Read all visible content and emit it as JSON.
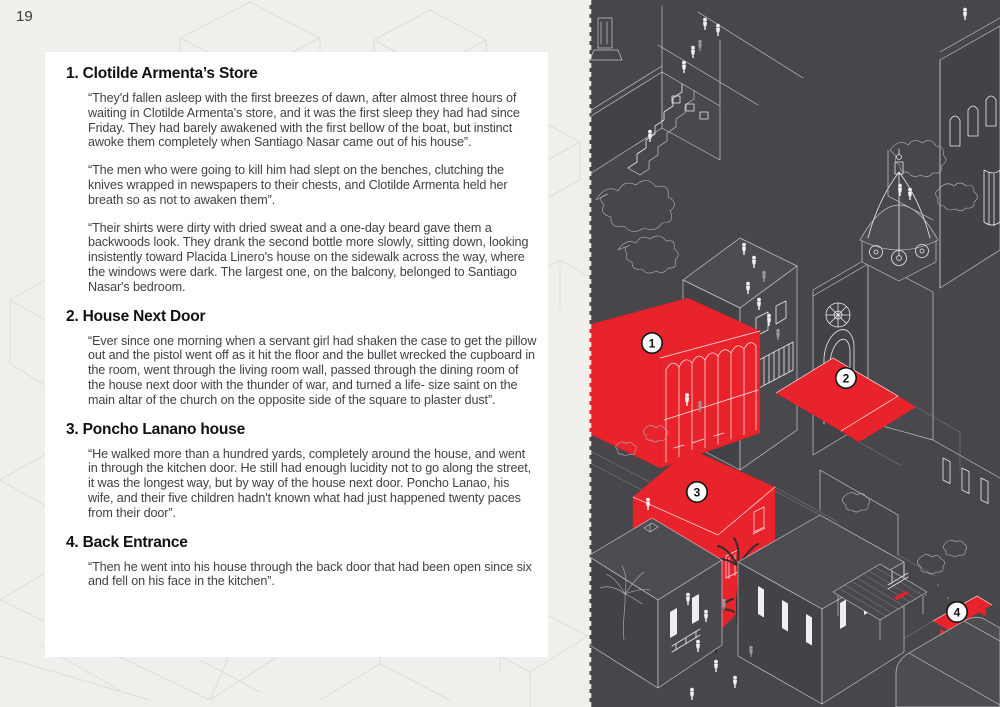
{
  "page_number": "19",
  "left_page": {
    "sections": [
      {
        "number": "1.",
        "title": "Clotilde Armenta’s Store",
        "paragraphs": [
          "“They'd fallen asleep with the first breezes of dawn, after almost three hours of waiting in Clotilde Armenta's store, and it was the first sleep they had had since Friday. They had barely awakened with the first bellow of the boat, but instinct awoke them completely when Santiago Nasar came out of his house”.",
          "“The men who were going to kill him had slept on the benches, clutching the knives wrapped in newspapers to their chests, and Clotilde Armenta held her breath so as not to awaken them”.",
          "“Their shirts were dirty with dried sweat and a one-day beard gave them a backwoods look. They drank the second bottle more slowly, sitting down, looking insistently toward Placida Linero's house on the sidewalk across the way, where the windows were dark. The largest one, on the balcony, belonged to Santiago Nasar's bedroom."
        ]
      },
      {
        "number": "2.",
        "title": "House Next Door",
        "paragraphs": [
          "“Ever since one morning when a servant girl had shaken the case to get the pillow out and the pistol went off as it hit the floor and the bullet wrecked the cupboard in the room, went through the living room wall, passed through the dining room of the house next door with the thunder of war, and turned a life- size saint on the main altar of the church on the opposite side of the square to plaster dust”."
        ]
      },
      {
        "number": "3.",
        "title": "Poncho Lanano house",
        "paragraphs": [
          "“He walked more than a hundred yards, completely around the house, and went in through the kitchen door. He still had enough lucidity not to go along the street, it was the longest way, but by way of the house next door. Poncho Lanao, his wife, and their five children hadn't known what had just happened twenty paces from their door”."
        ]
      },
      {
        "number": "4.",
        "title": "Back Entrance",
        "paragraphs": [
          "“Then he went into his house through the back door that had been open since six and fell on his face in the kitchen”."
        ]
      }
    ]
  },
  "illustration": {
    "kind": "isometric town map, dark with red highlighted locations",
    "markers": [
      "1",
      "2",
      "3",
      "4"
    ],
    "colors": {
      "background": "#47474b",
      "line_art": "#c6c6cc",
      "highlight_red": "#e8232b",
      "marker_fill": "#ffffff",
      "marker_text": "#141414",
      "page_background": "#f1efec",
      "text_box": "#ffffff"
    }
  }
}
